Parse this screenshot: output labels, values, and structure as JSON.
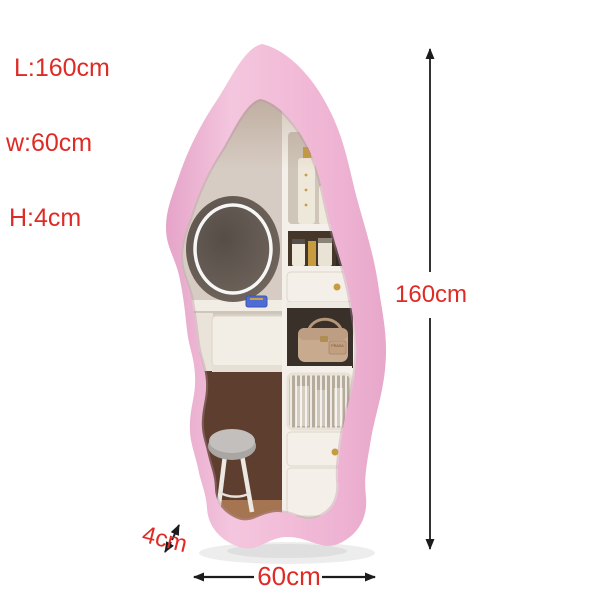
{
  "colors": {
    "bg": "#ffffff",
    "accent-red": "#df2b26",
    "dim-line": "#1c1c1c",
    "frame-pink": "#f2c0da",
    "frame-pink-dark": "#e5a4c8",
    "frame-pink-light": "#f8d2e6",
    "glass-beige": "#d7ccc3",
    "wall-brown": "#5e3f2f",
    "floor-tan": "#a57450",
    "cabinet-white": "#f4f0e9",
    "gold": "#c79b3f",
    "bag-tan": "#c8aa8f"
  },
  "annotations": {
    "spec_lines": [
      "L:160cm",
      "w:60cm",
      "H:4cm"
    ],
    "height_label": "160cm",
    "width_label": "60cm",
    "depth_label": "4cm"
  },
  "product": {
    "reflection": {
      "handbag_label": "PRADA"
    }
  }
}
